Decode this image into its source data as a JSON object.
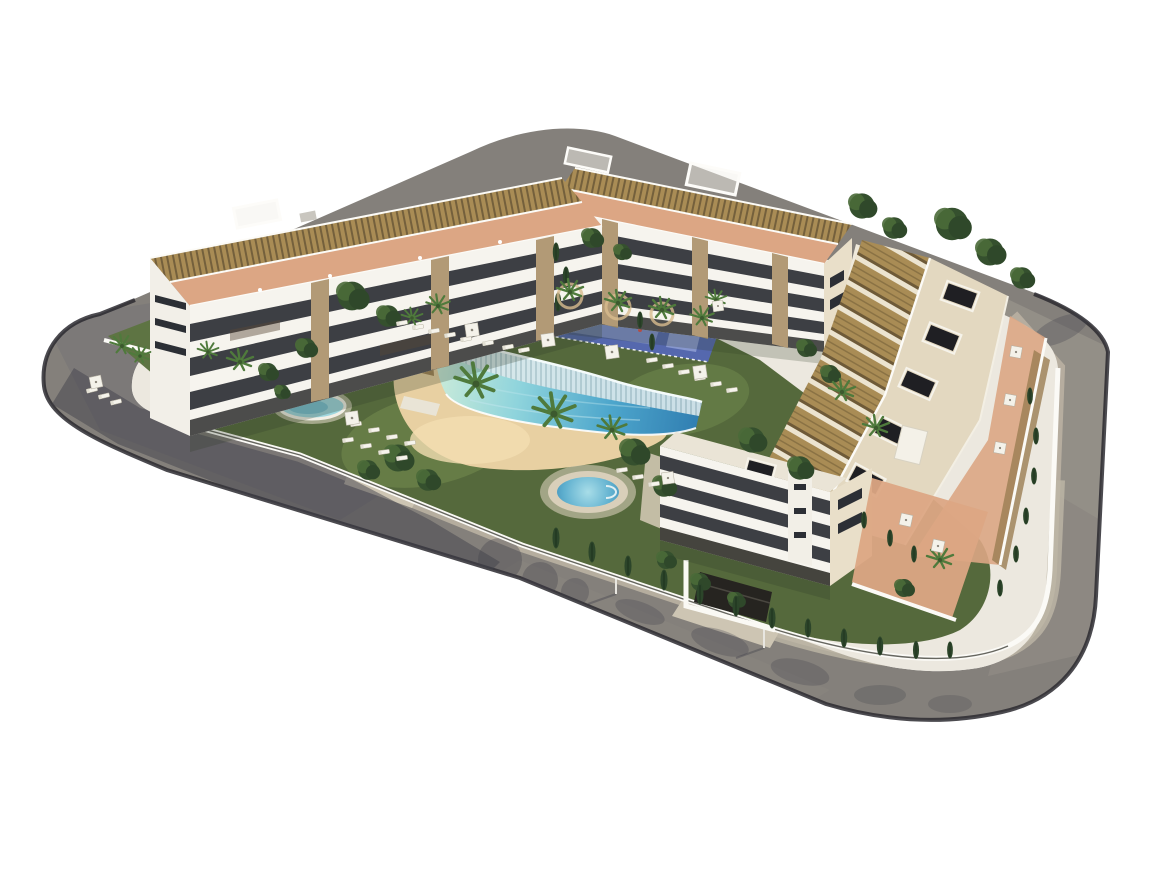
{
  "meta": {
    "type": "3d-architectural-aerial-render",
    "title": "Residential complex aerial rendering",
    "description": "Bird's-eye 3D render of a modern white apartment development on a rounded corner plot surrounded by a perimeter road. Three long apartment wings with rooftop pergolas and terracotta terraces enclose a landscaped courtyard containing a lagoon-style swimming pool with a sand beach, a round spa pool, a small kids pool, a blue playground court, lawns with sun loungers and parasols, palm trees and cypresses. A corner apartment block with a garage entrance sits at the lower right.",
    "no_visible_text": true,
    "background": "#ffffff"
  },
  "scene": {
    "colors": {
      "background": "#ffffff",
      "road_asphalt": "#84807b",
      "road_asphalt_light": "#a19b92",
      "road_shadow": "#42414b",
      "road_edge": "#2b2a30",
      "sidewalk": "#b7afa0",
      "sidewalk_light": "#cdc5b3",
      "plot_base": "#ece8df",
      "wall_white": "#fbfaf6",
      "facade_white": "#f6f4ee",
      "facade_cream": "#e9dfc9",
      "window_dark": "#2c2f35",
      "stone_pillar": "#b29a76",
      "pergola_brown": "#a98c55",
      "pergola_line": "#74603c",
      "terrace_terracotta": "#dca684",
      "roof_cream": "#e3d8c0",
      "roof_hatch": "#1f1f23",
      "lawn_dark": "#55693c",
      "lawn_light": "#6a8148",
      "tree_dark": "#35502e",
      "tree_mid": "#4a6a38",
      "palm_green": "#4f7a3c",
      "cypress": "#2c452a",
      "sand": "#e8d0a2",
      "sand_light": "#f2ddb2",
      "pool_shallow": "#c8ead9",
      "pool_mid": "#8fd4dc",
      "pool_deep2": "#4da6cc",
      "pool_deep": "#2f7cb0",
      "pool_rim": "#f4fbfb",
      "cascade": "#dce9ec",
      "playground_blue": "#5568ae",
      "playground_light": "#8292cc",
      "spa_rim": "#d9cfba",
      "umbrella": "#f4f2ea"
    },
    "counts": {
      "building_wings": 3,
      "corner_buildings": 1,
      "swimming_pools": 3,
      "playground_courts": 1,
      "garage_entrances": 1
    },
    "elements": [
      {
        "name": "perimeter-road",
        "description": "Gray asphalt road ring with rounded corners wrapping the plot"
      },
      {
        "name": "sidewalk",
        "description": "Beige sidewalk band along the inner edge of the road"
      },
      {
        "name": "left-wing-building",
        "description": "Four-storey white apartment wing with balcony bands, stone pillars and rooftop pergolas"
      },
      {
        "name": "back-wing-building",
        "description": "Four-storey white apartment wing at the rear with rooftop pergolas and cream end face"
      },
      {
        "name": "right-wing-building",
        "description": "Long townhouse wing with cream roof, dark roof hatches and rows of brown pergolas"
      },
      {
        "name": "corner-building",
        "description": "White apartment block at the south-east corner above the garage entrance"
      },
      {
        "name": "northeast-villas",
        "description": "Low roofs with pergolas partly hidden by trees at the north-east"
      },
      {
        "name": "lagoon-pool",
        "description": "Curved lagoon-style pool with cascade edge and gradient blue water"
      },
      {
        "name": "sand-beach",
        "description": "Sand-colored beach area wrapping the lagoon pool"
      },
      {
        "name": "spa-pool",
        "description": "Round spa pool with beige deck ring"
      },
      {
        "name": "kids-pool",
        "description": "Small oval pool in the west garden strip"
      },
      {
        "name": "playground-court",
        "description": "Blue-floored playground court with palm planters"
      },
      {
        "name": "lawns",
        "description": "Dark and light green lawn areas"
      },
      {
        "name": "palm-trees",
        "description": "Palm trees around the pool and gardens"
      },
      {
        "name": "cypress-trees",
        "description": "Slim cypresses along the perimeter walls"
      },
      {
        "name": "leafy-trees",
        "description": "Round leafy canopies in courtyard and behind buildings"
      },
      {
        "name": "sun-loungers",
        "description": "Rows of white sun loungers on the lawns"
      },
      {
        "name": "parasols",
        "description": "White square parasols on lawns and terraces"
      },
      {
        "name": "garage-entrance",
        "description": "Dark garage ramp with light apron on the bottom road"
      },
      {
        "name": "building-shadows",
        "description": "Long shadows cast across the road to the lower left"
      }
    ]
  }
}
